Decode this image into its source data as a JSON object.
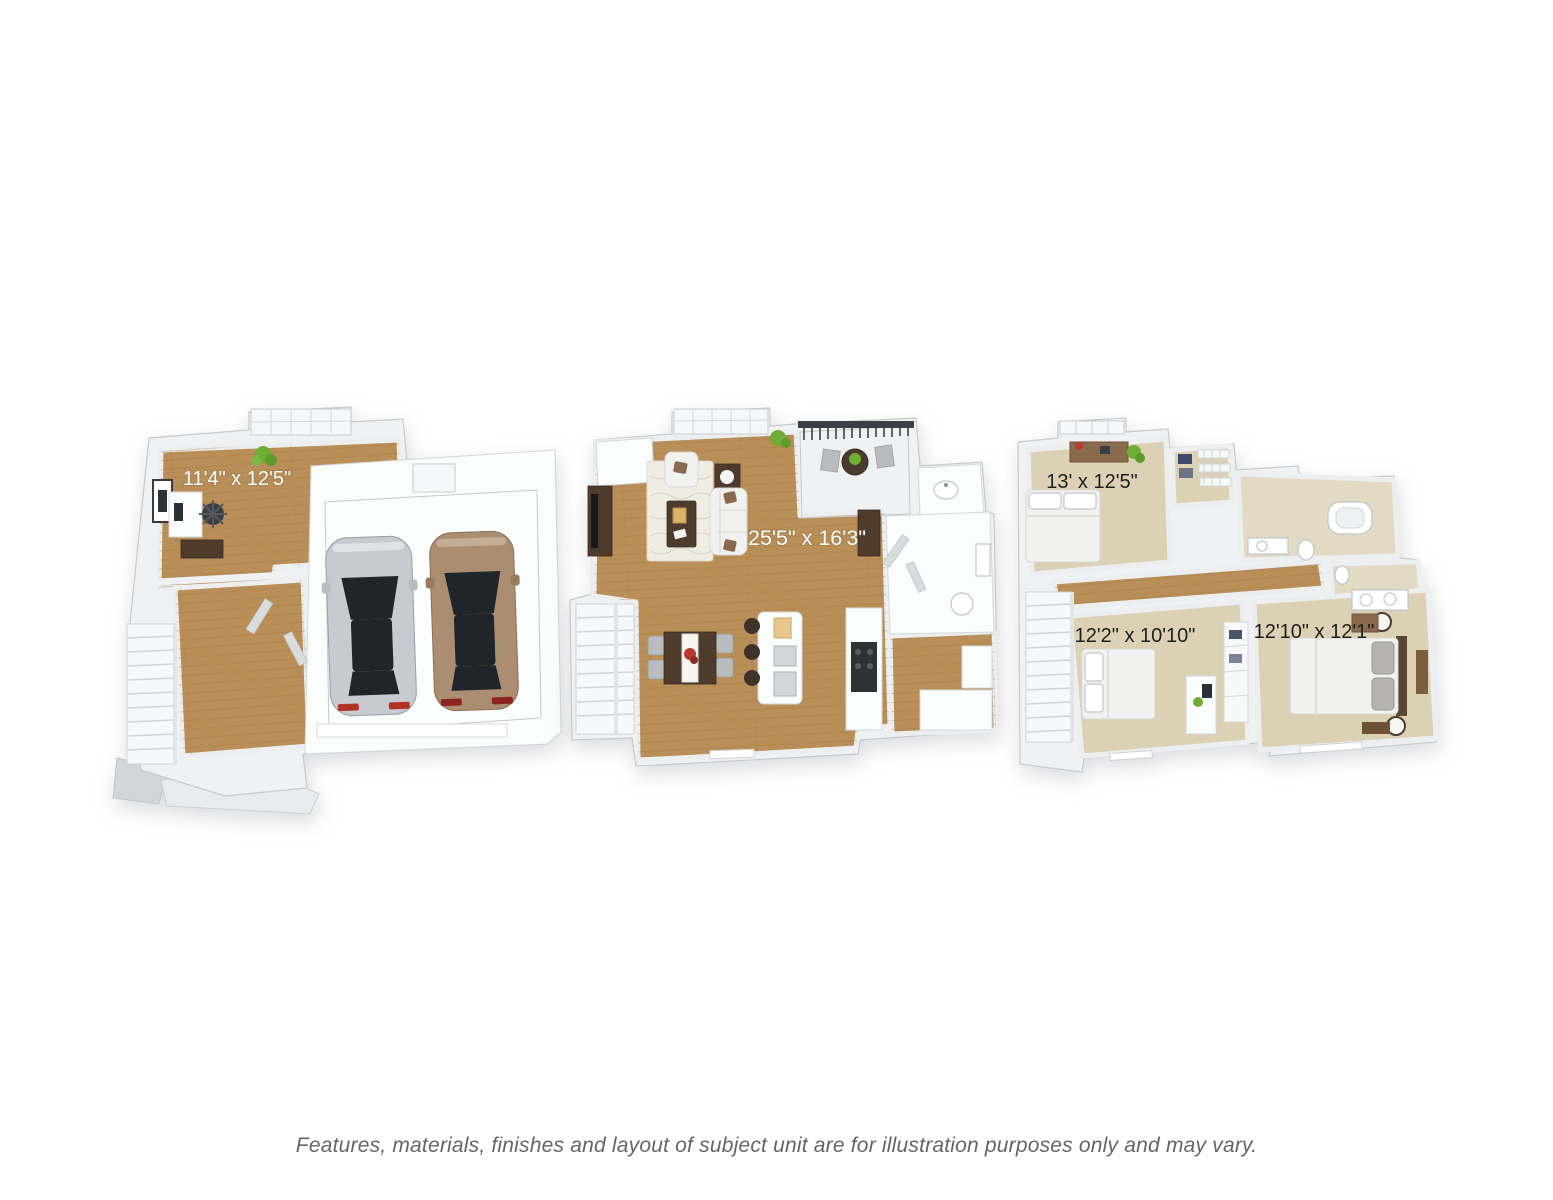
{
  "page": {
    "background": "#ffffff",
    "disclaimer": "Features, materials, finishes and layout of subject unit are for illustration purposes only and may vary."
  },
  "floor_plans": [
    {
      "id": "garage-entry-level",
      "description": "Entry level with office area, staircase and two-car garage",
      "room_labels": [
        {
          "text": "11'4\" x 12'5\"",
          "color": "#ffffff"
        }
      ],
      "objects": [
        "desk",
        "office-chair",
        "framed-picture",
        "potted-plant",
        "credenza",
        "staircase",
        "silver-car",
        "tan-car"
      ]
    },
    {
      "id": "main-living-level",
      "description": "Open living, dining and kitchen level with balcony and half bath",
      "room_labels": [
        {
          "text": "25'5\" x 16'3\"",
          "color": "#ffffff"
        }
      ],
      "objects": [
        "tv-console",
        "armchair",
        "sofa",
        "rug",
        "coffee-table",
        "floor-lamp",
        "balcony-set",
        "dining-table",
        "kitchen-island",
        "range",
        "staircase",
        "half-bath-sink",
        "toilet"
      ]
    },
    {
      "id": "bedroom-level",
      "description": "Upper level with three bedrooms, two baths and walk-in closet",
      "room_labels": [
        {
          "text": "13' x 12'5\"",
          "color": "#1f1f1f"
        },
        {
          "text": "12'2\" x 10'10\"",
          "color": "#1f1f1f"
        },
        {
          "text": "12'10\" x 12'1\"",
          "color": "#1f1f1f"
        }
      ],
      "objects": [
        "bed-1",
        "dresser",
        "walk-in-closet",
        "bathtub",
        "double-vanity",
        "bed-2",
        "desk",
        "wardrobe",
        "bed-3",
        "nightstand-lamps",
        "staircase"
      ]
    }
  ],
  "palette": {
    "wall": "#f0f1f3",
    "wall_edge": "#c7cacc",
    "wood_floor": "#b98e57",
    "garage_floor": "#dcdee0",
    "balcony_floor": "#ccd0d2",
    "carpet": "#ddd1b5",
    "bath_floor": "#e3dac4",
    "label_light": "#ffffff",
    "label_dark": "#1f1f1f",
    "car_silver": "#c7cad0",
    "car_tan": "#ab8e72",
    "plant_green": "#6fae35",
    "flower_red": "#b8392e",
    "furniture_dark_wood": "#4e3b2c",
    "disclaimer_text": "#636567"
  }
}
